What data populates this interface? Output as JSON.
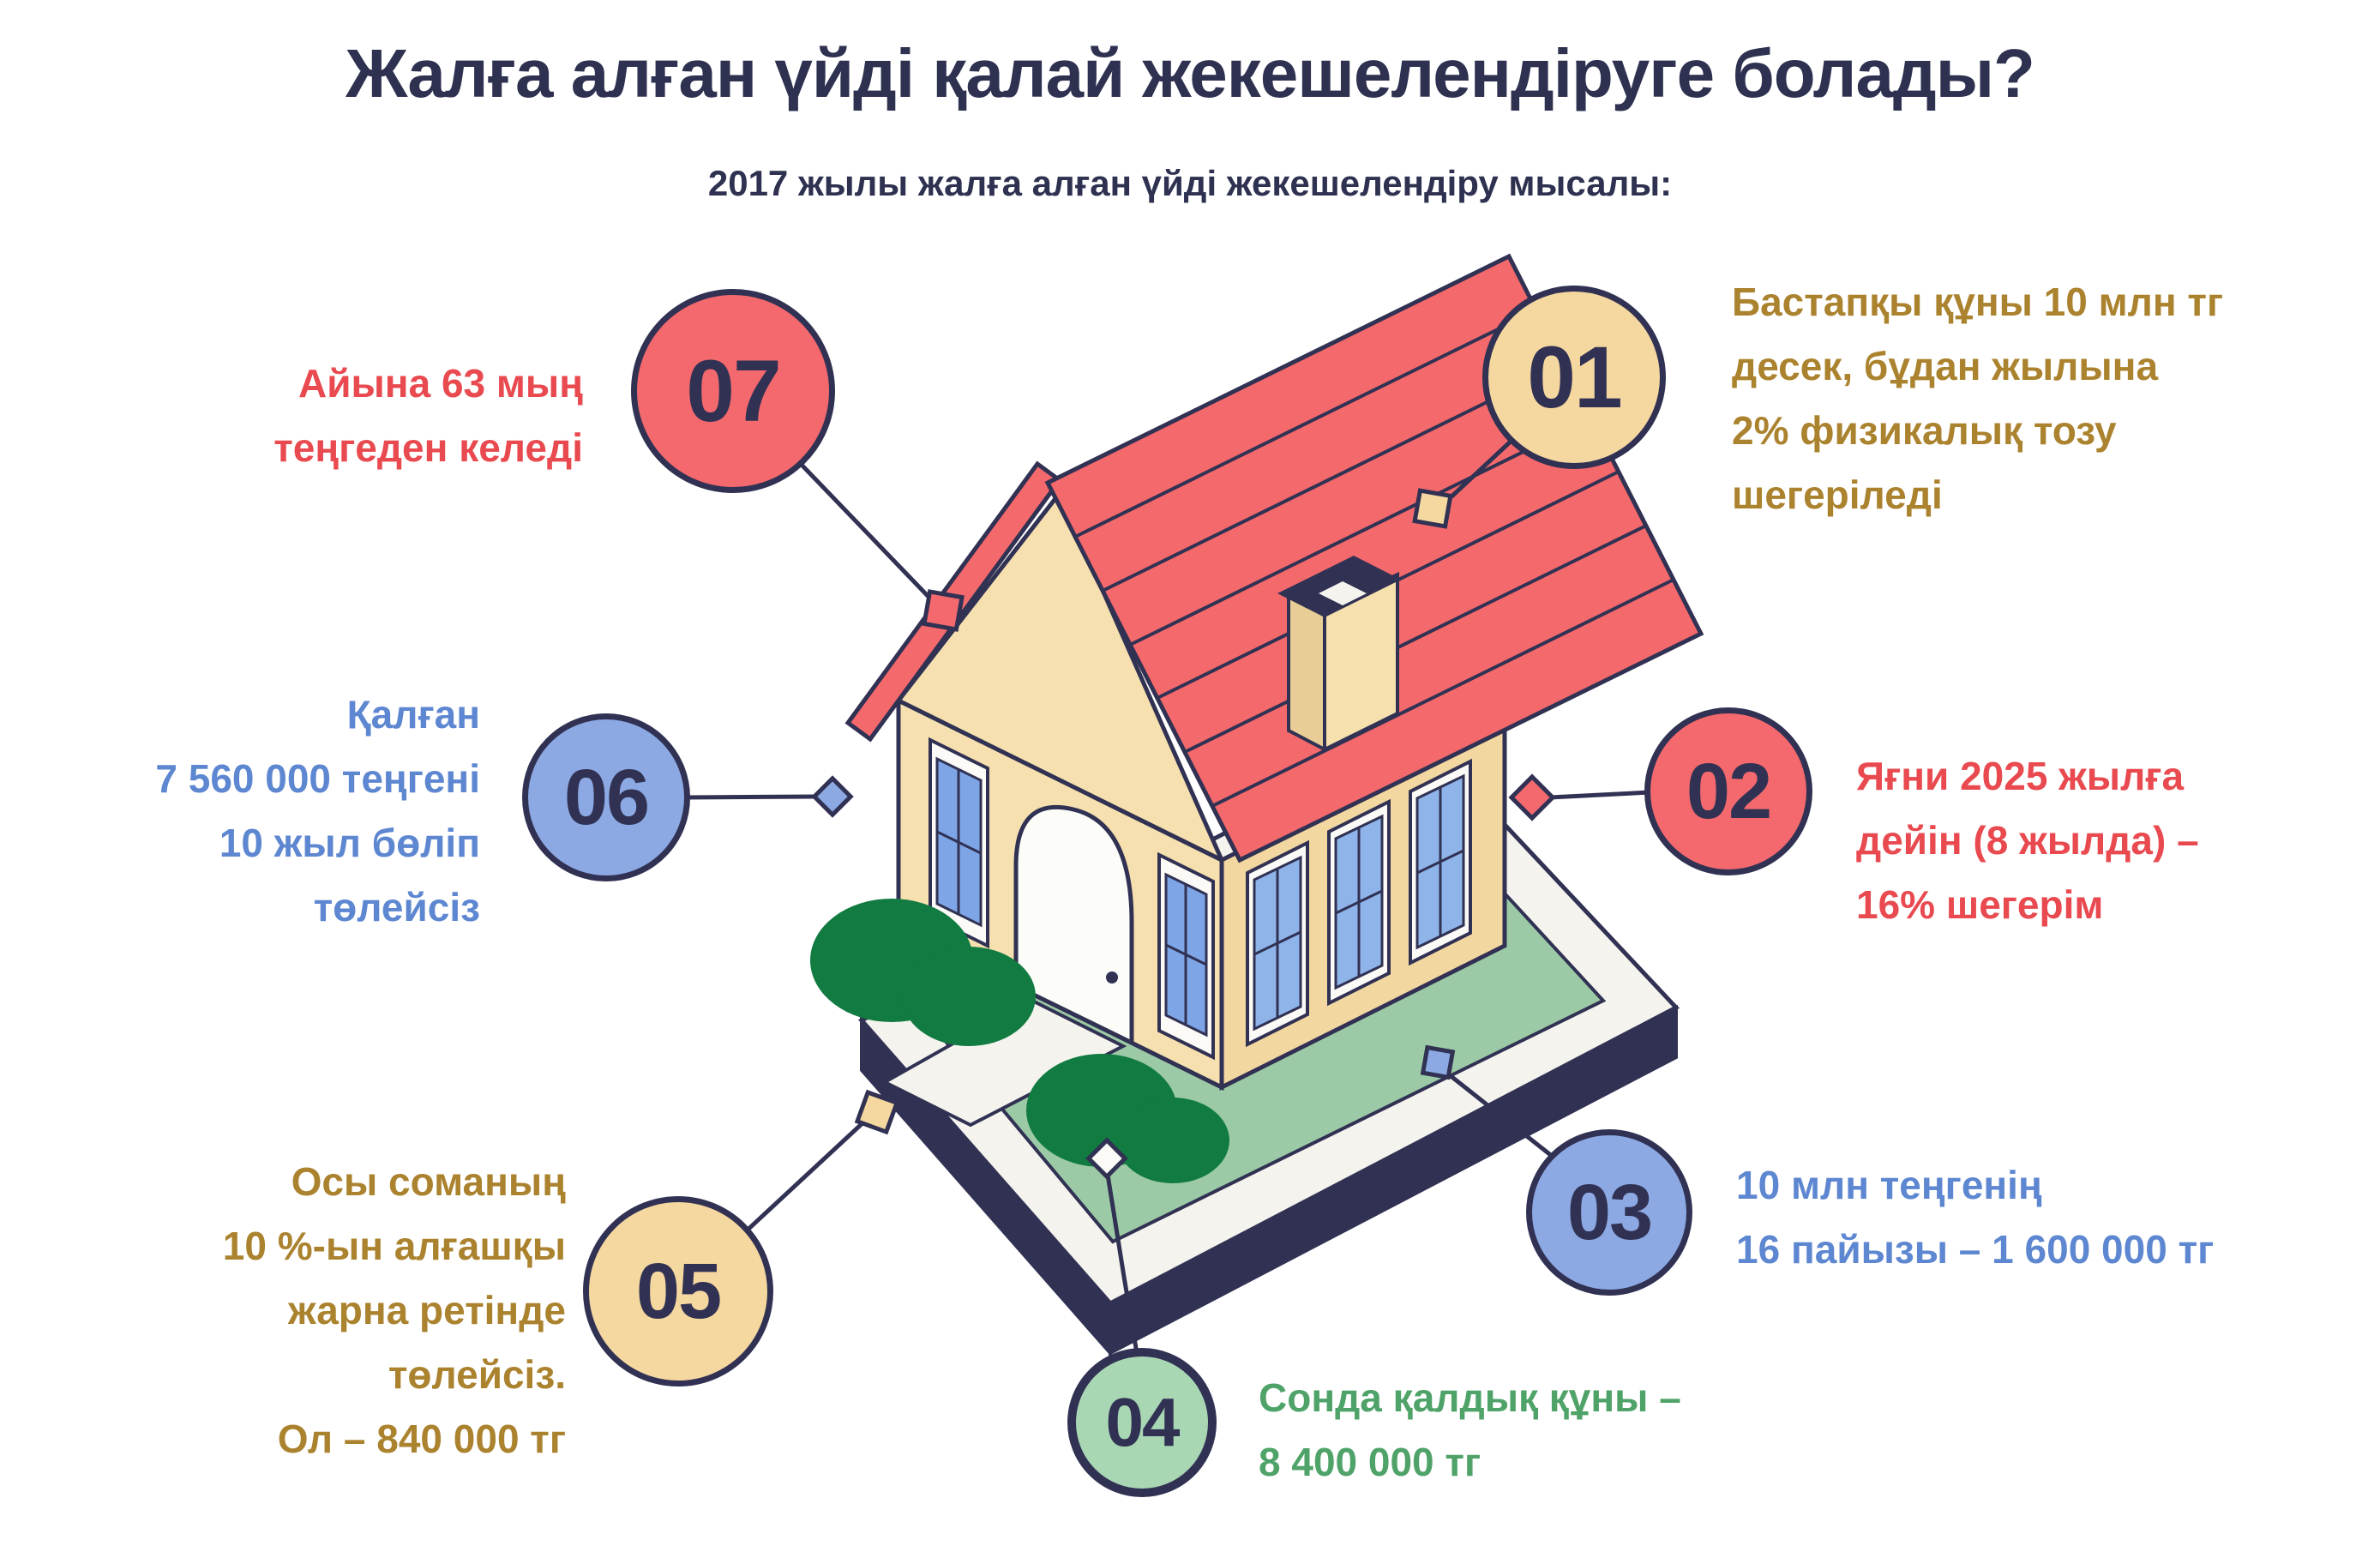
{
  "header": {
    "title": "Жалға алған үйді қалай жекешелендіруге болады?",
    "subtitle": "2017 жылы жалға алған үйді жекешелендіру мысалы:"
  },
  "steps": [
    {
      "label": "01",
      "text": "Бастапқы құны 10 млн тг\nдесек, бұдан жылына\n2% физикалық тозу\nшегеріледі",
      "circle_color": "#F5D7A0",
      "text_color": "#AB832F",
      "marker": "square"
    },
    {
      "label": "02",
      "text": "Яғни 2025 жылға\nдейін (8 жылда) –\n16% шегерім",
      "circle_color": "#F4696E",
      "text_color": "#E94A50",
      "marker": "diamond"
    },
    {
      "label": "03",
      "text": "10 млн теңгенің\n16 пайызы – 1 600 000 тг",
      "circle_color": "#8CA9E4",
      "text_color": "#5E87D1",
      "marker": "square"
    },
    {
      "label": "04",
      "text": "Сонда қалдық құны –\n8 400 000 тг",
      "circle_color": "#A9D7B4",
      "text_color": "#4FA369",
      "marker": "diamond"
    },
    {
      "label": "05",
      "text": "Осы соманың\n10 %-ын алғашқы\nжарна ретінде\nтөлейсіз.\nОл – 840 000 тг",
      "circle_color": "#F5D7A0",
      "text_color": "#AB832F",
      "marker": "square"
    },
    {
      "label": "06",
      "text": "Қалған\n7 560 000 теңгені\n10 жыл бөліп\nтөлейсіз",
      "circle_color": "#8CA9E4",
      "text_color": "#5E87D1",
      "marker": "diamond"
    },
    {
      "label": "07",
      "text": "Айына 63 мың\nтеңгеден келеді",
      "circle_color": "#F4696E",
      "text_color": "#E94A50",
      "marker": "square"
    }
  ],
  "illustration": {
    "name": "isometric-house",
    "colors": {
      "outline_navy": "#313253",
      "roof_red": "#F4696C",
      "wall_tan": "#F2D7A0",
      "gable_tan": "#F6E0B0",
      "lawn_green": "#9CCAA6",
      "bush_green": "#117B41",
      "walkway_white": "#F5F3EE",
      "window_blue": "#7EA6E6"
    }
  }
}
